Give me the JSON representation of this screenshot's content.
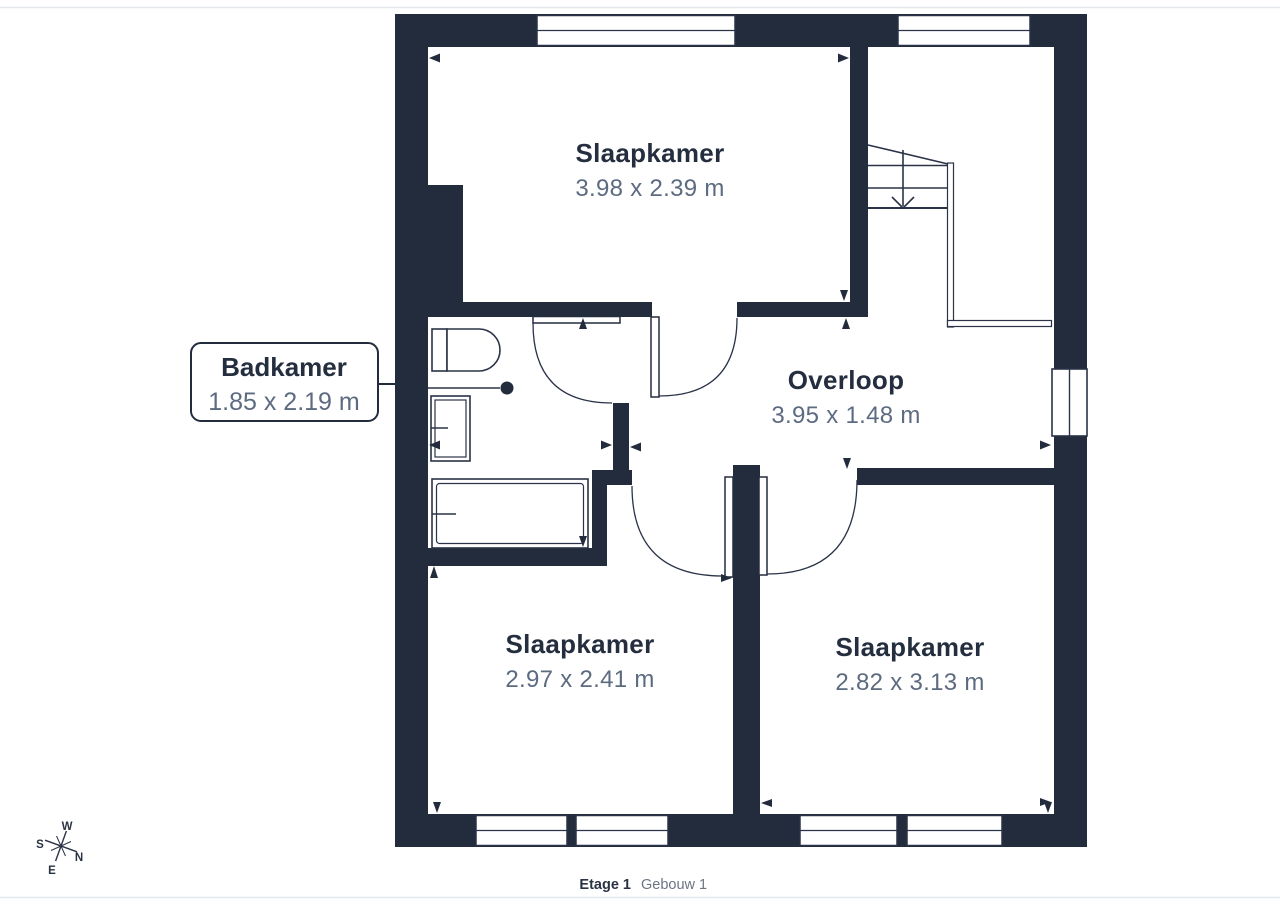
{
  "page": {
    "caption": {
      "floor": "Etage 1",
      "building": "Gebouw 1"
    }
  },
  "floorplan": {
    "rooms": [
      {
        "label": "Slaapkamer",
        "dims": "3.98 x 2.39 m"
      },
      {
        "label": "Overloop",
        "dims": "3.95 x 1.48 m"
      },
      {
        "label": "Slaapkamer",
        "dims": "2.97 x 2.41 m"
      },
      {
        "label": "Slaapkamer",
        "dims": "2.82 x 3.13 m"
      }
    ],
    "callout": {
      "label": "Badkamer",
      "dims": "1.85 x 2.19 m"
    }
  },
  "compass": {
    "n": "N",
    "e": "E",
    "s": "S",
    "w": "W"
  },
  "colors": {
    "wall": "#232c3d",
    "room_title": "#242e3f",
    "dim_text": "#5d6b80",
    "caption_muted": "#6b7583",
    "page_border": "#e4e7eb",
    "background": "#ffffff"
  }
}
